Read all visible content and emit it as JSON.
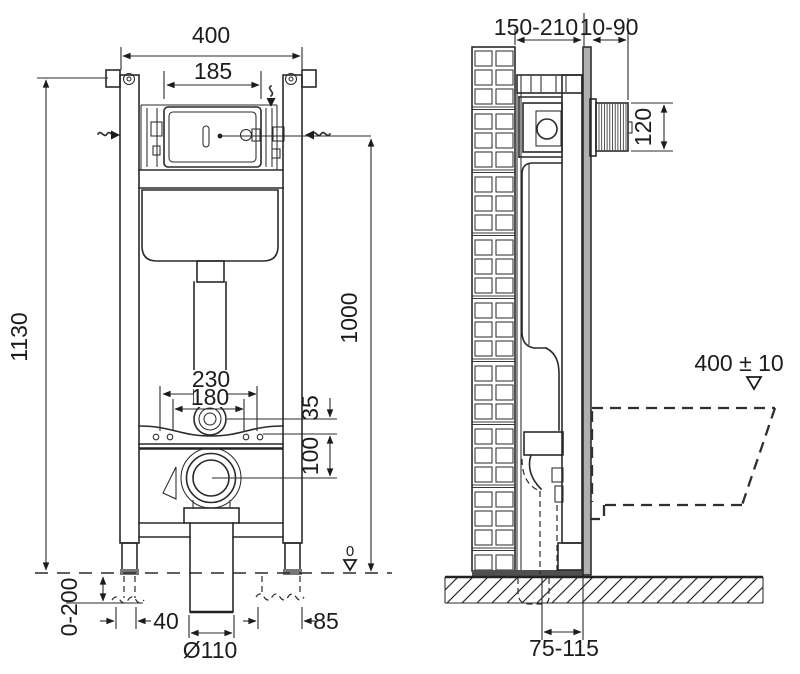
{
  "front": {
    "width": "400",
    "access": "185",
    "height": "1130",
    "flush_height": "1000",
    "rod_spacing": "230",
    "bolt_spacing": "180",
    "offset35": "35",
    "offset100": "100",
    "leg_range": "0-200",
    "left40": "40",
    "right85": "85",
    "drain": "Ø110",
    "zero": "0"
  },
  "side": {
    "depth": "150-210",
    "finish": "10-90",
    "unit_h": "120",
    "rim": "400 ± 10",
    "axis": "75-115"
  },
  "colors": {
    "panel": "#b0b0b0",
    "plate": "#4f4f4f"
  }
}
